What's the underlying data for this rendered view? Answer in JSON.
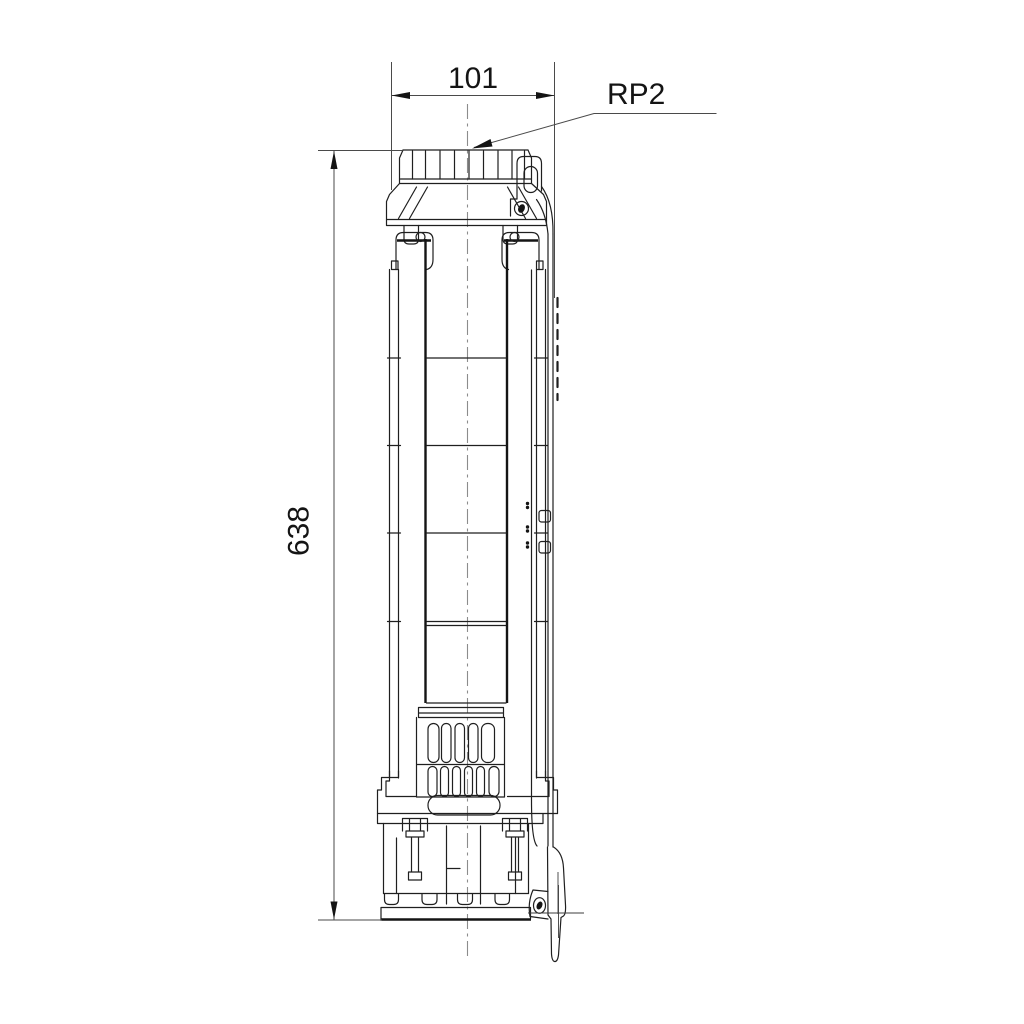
{
  "drawing": {
    "labels": {
      "width_dimension": "101",
      "height_dimension": "638",
      "connection_label": "RP2"
    },
    "colors": {
      "background": "#ffffff",
      "line": "#1f1f1f",
      "dimension": "#4a4a4a",
      "centerline": "#8c8c8c"
    }
  }
}
